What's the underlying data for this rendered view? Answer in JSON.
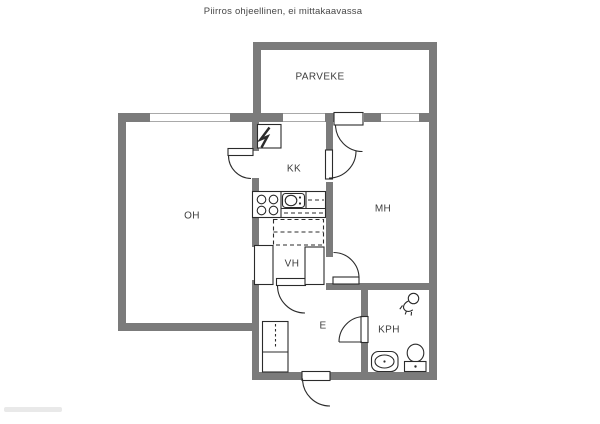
{
  "title": "Piirros ohjeellinen, ei mittakaavassa",
  "rooms": {
    "parveke": {
      "label": "PARVEKE"
    },
    "oh": {
      "label": "OH"
    },
    "kk": {
      "label": "KK"
    },
    "mh": {
      "label": "MH"
    },
    "vh": {
      "label": "VH"
    },
    "e": {
      "label": "E"
    },
    "kph": {
      "label": "KPH"
    }
  },
  "colors": {
    "wall": "#7b7b7b",
    "line": "#2b2b2b",
    "window_line": "#a9a9a9",
    "label_text": "#3d3d3d",
    "title_text": "#474747",
    "background": "#ffffff",
    "watermark": "#e9e9e9"
  },
  "icons": {
    "electrical-panel-icon": "lightning-bolt",
    "stove-icon": "four-burners",
    "sink-icon": "kitchen-sink-basin",
    "shower-icon": "shower-head",
    "washbasin-icon": "bathroom-sink",
    "toilet-icon": "toilet-seat"
  }
}
